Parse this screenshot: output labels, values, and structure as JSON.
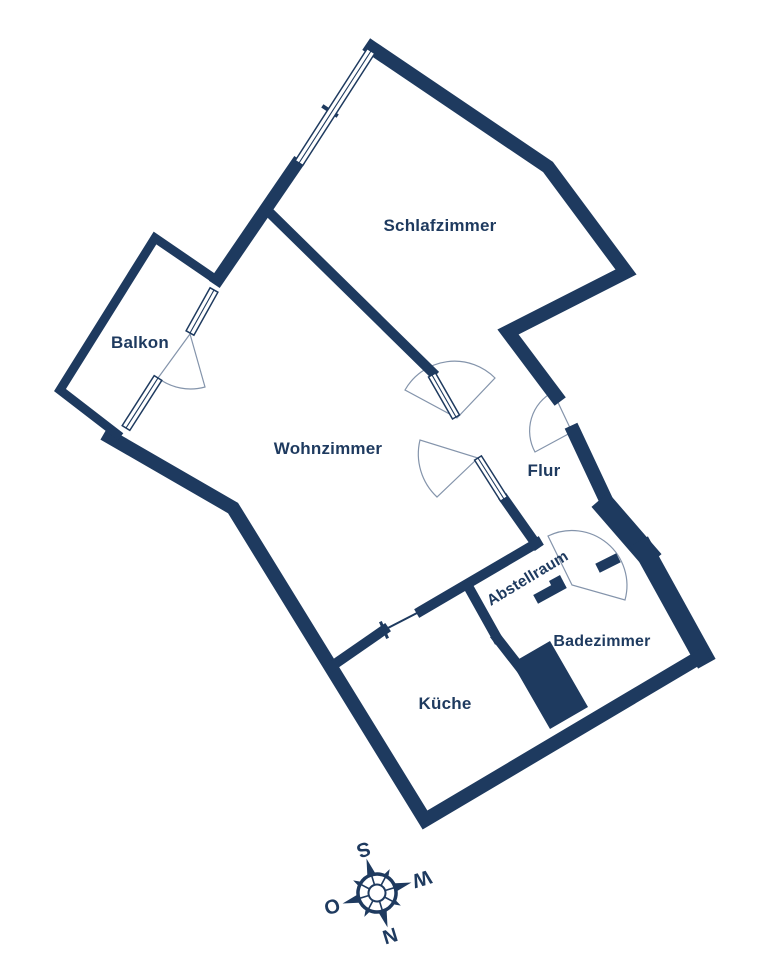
{
  "palette": {
    "wall": "#1e3a5f",
    "door_arc": "#8494ab",
    "label_text": "#1e3a5f",
    "background": "#ffffff"
  },
  "rooms": [
    {
      "id": "schlafzimmer",
      "label": "Schlafzimmer"
    },
    {
      "id": "balkon",
      "label": "Balkon"
    },
    {
      "id": "wohnzimmer",
      "label": "Wohnzimmer"
    },
    {
      "id": "flur",
      "label": "Flur"
    },
    {
      "id": "abstellraum",
      "label": "Abstellraum"
    },
    {
      "id": "badezimmer",
      "label": "Badezimmer"
    },
    {
      "id": "kueche",
      "label": "Küche"
    }
  ],
  "compass": {
    "north": "N",
    "east": "O",
    "south": "S",
    "west": "W"
  }
}
